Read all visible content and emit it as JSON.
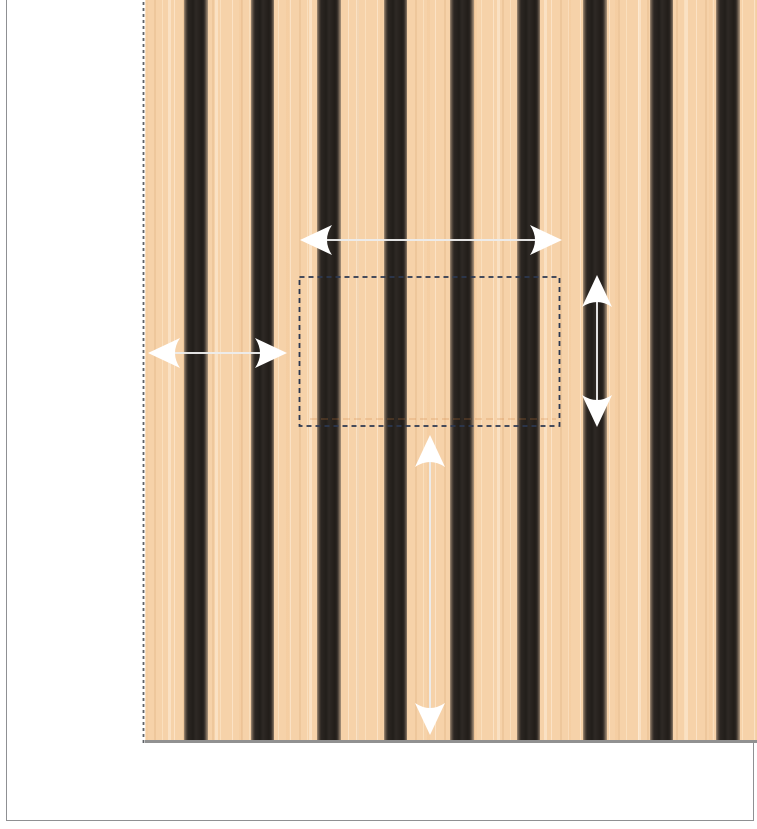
{
  "canvas": {
    "background": "#ffffff",
    "page_frame": {
      "left": 6,
      "top": -10,
      "width": 748,
      "height": 831,
      "border_color": "#8f9093"
    }
  },
  "panel": {
    "left": 145,
    "top": 0,
    "width": 612,
    "height": 743,
    "wood_base_color": "#f6d2a9",
    "slat_color": "#282320",
    "slat_bevel_color": "#9a8773",
    "bottom_edge_color": "#919191",
    "slats": {
      "count": 9,
      "first_offset": 39,
      "spacing": 66.5,
      "width": 23.5
    },
    "edge_guide": {
      "x": 143.5,
      "y1": 2,
      "y2": 743,
      "color": "#5f6368",
      "dash": "3 3",
      "stroke_width": 1.8
    }
  },
  "selection": {
    "x": 299.5,
    "y": 277,
    "width": 260,
    "height": 149,
    "stroke": "#2c3850",
    "dash": "5 4",
    "stroke_width": 1.8,
    "seam": {
      "x1": 310,
      "x2": 556,
      "y": 419,
      "color": "rgba(205,125,60,0.28)",
      "dash": "7 4"
    }
  },
  "arrows": [
    {
      "name": "width-arrow",
      "orientation": "horizontal",
      "x1": 300,
      "y1": 240,
      "x2": 562,
      "y2": 240
    },
    {
      "name": "left-offset-arrow",
      "orientation": "horizontal",
      "x1": 148,
      "y1": 353,
      "x2": 287,
      "y2": 353
    },
    {
      "name": "height-arrow",
      "orientation": "vertical",
      "x1": 597,
      "y1": 275,
      "x2": 597,
      "y2": 427
    },
    {
      "name": "bottom-offset-arrow",
      "orientation": "vertical",
      "x1": 430,
      "y1": 435,
      "x2": 430,
      "y2": 735
    }
  ],
  "arrow_style": {
    "head_fill": "#ffffff",
    "shaft_color": "#ededed",
    "shaft_width": 2,
    "head_length": 32,
    "head_half_width": 15,
    "head_notch": 10
  }
}
